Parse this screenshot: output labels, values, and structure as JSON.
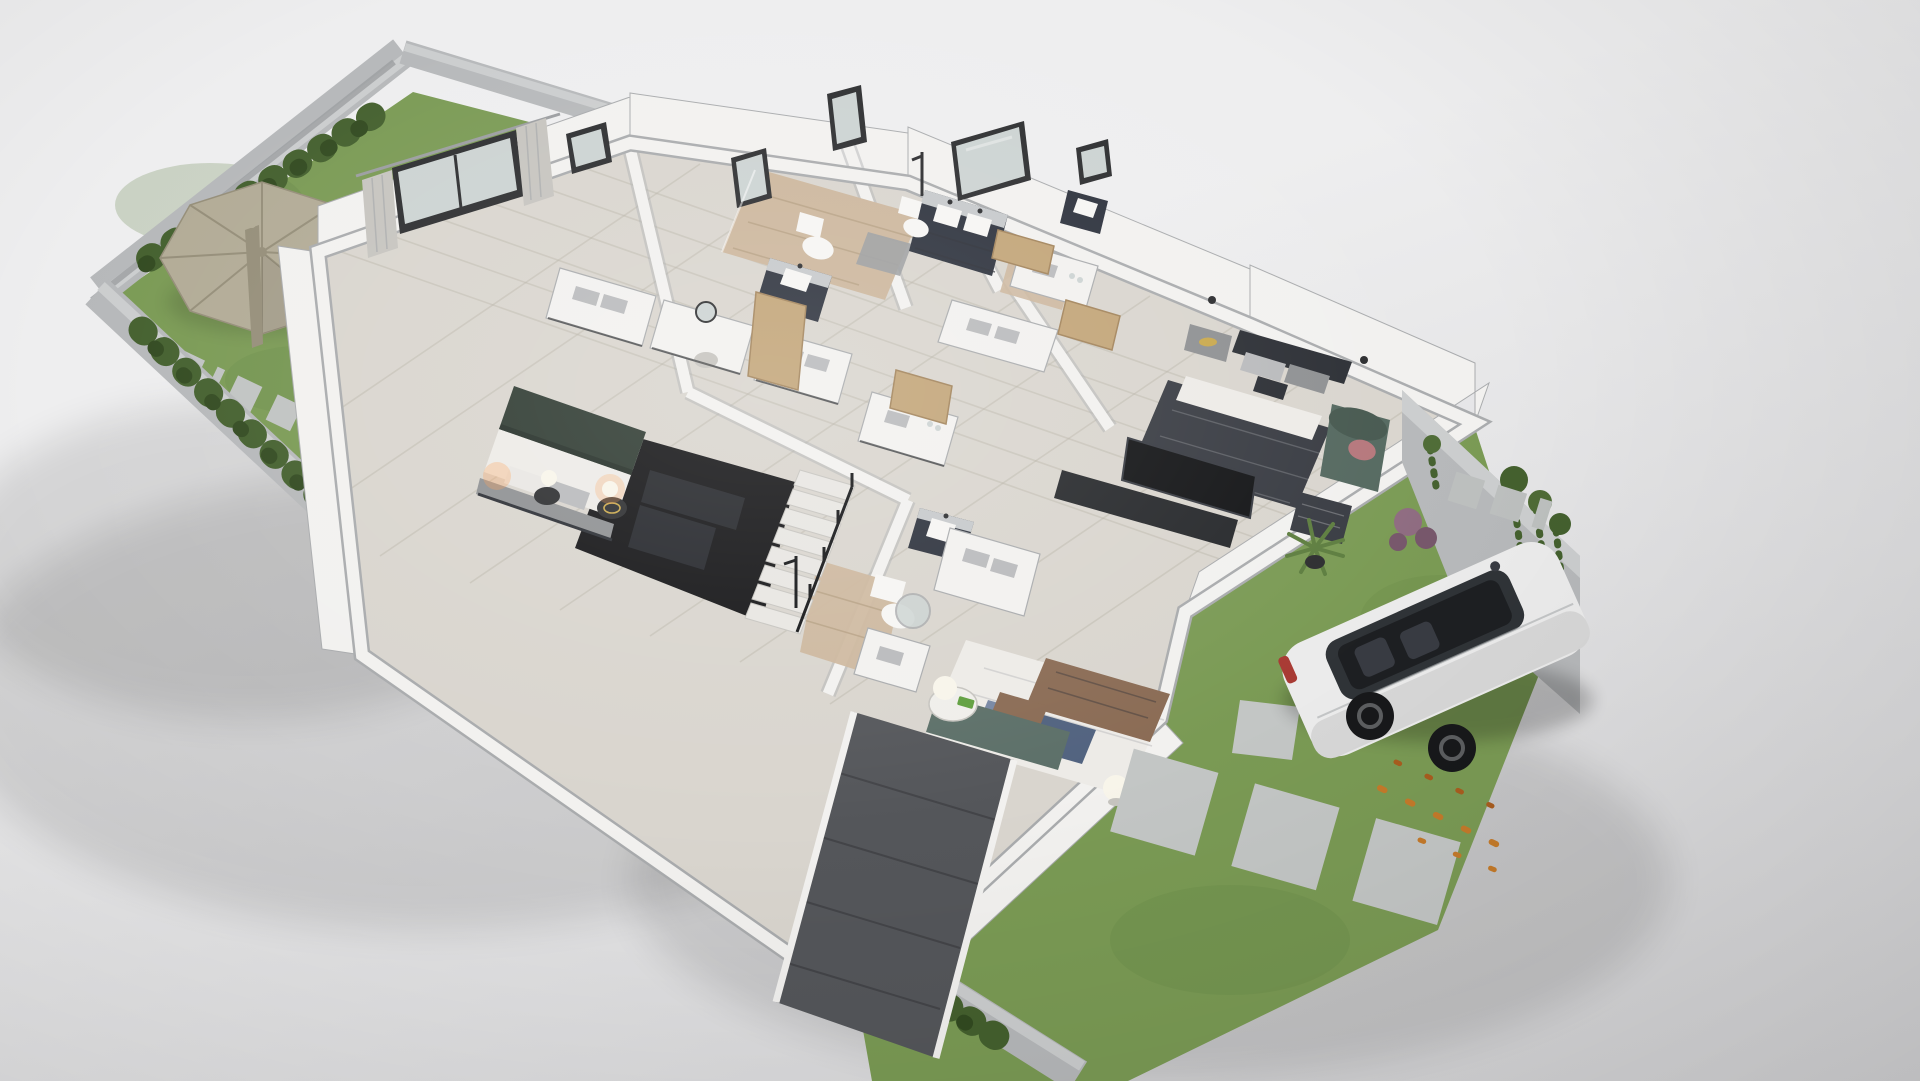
{
  "scene": {
    "kind": "3d-dollhouse-floorplan-render",
    "description": "Photorealistic cutaway 3D floor plan of an upper residential storey on a neutral gray studio backdrop, viewed from a high south-west angle",
    "no_visible_text": true
  },
  "palette": {
    "bg_top": "#eeeeef",
    "bg_bottom": "#d2d2d4",
    "shadow": "#000000",
    "concrete": "#b6b8ba",
    "concrete_light": "#cbcdce",
    "concrete_dark": "#9b9da0",
    "wall_white": "#f2f1ef",
    "wall_edge": "#a9abad",
    "floor_tile": "#d9d5ce",
    "floor_line": "#b4aea3",
    "wood": "#ccb69c",
    "wood_line": "#ac9678",
    "grass": "#7a9a54",
    "grass_dark": "#5f8142",
    "hedge": "#44602e",
    "hedge_dark": "#324a20",
    "stone": "#c0c3c2",
    "paver": "#c3c6c5",
    "paver_small": "#bcbfbe",
    "umbrella": "#b2ab96",
    "umbrella_dark": "#958e79",
    "navy": "#2c313c",
    "navy_top": "#c6c9cb",
    "sink": "#f6f5f3",
    "mattress": "#edebe7",
    "pillow_gray": "#b9babc",
    "duvet_green": "#2e3a31",
    "duvet_green_dark": "#242e27",
    "headboard": "#8e9092",
    "charcoal": "#383b42",
    "charcoal_dark": "#2b2e34",
    "sheet": "#e9e7e3",
    "blue_pillow": "#7787a3",
    "blue_dark": "#51627f",
    "throw_brown": "#8a6b54",
    "teal_sofa": "#5c6f68",
    "teal_chair": "#54685f",
    "teal_chair_dark": "#46584f",
    "pink": "#b5767b",
    "door_tan": "#c2a477",
    "door_tan_dark": "#a2835a",
    "tv": "#131416",
    "console_dark": "#26282b",
    "void": "#141416",
    "void_soft": "#26282c",
    "stairs": "#e8e6e2",
    "riser": "#c6c4bf",
    "ramp": "#54565a",
    "ramp_line": "#3e4043",
    "car_body": "#ebebeb",
    "car_side": "#d7d7d7",
    "car_glass": "#2f3337",
    "car_glass_dark": "#1d1f22",
    "wheel": "#17181a",
    "rim": "#5c5e60",
    "taillight": "#a83a33",
    "leaf_orange": "#c47a2a",
    "leaf_orange2": "#a85d1f",
    "gold": "#c9a84c",
    "lamp": "#f8f5ea",
    "glow_warm": "#ff9d4d",
    "plant": "#4e6b35",
    "plant2": "#5d7d3f",
    "purple_shrub": "#8e6b80",
    "purple_shrub2": "#76566a",
    "mirror_frame": "#2c2d2f",
    "mirror_glass": "#ccd3d2",
    "metal": "#2b2c2e",
    "table_white": "#efeeea",
    "white": "#ffffff",
    "book_green": "#5f9e3e"
  },
  "rooms": [
    {
      "name": "garden-patio",
      "features": [
        "lawn",
        "open-patio-umbrella",
        "closed-umbrella",
        "hedge-rows",
        "stepping-stones",
        "potted-palms",
        "concrete-boundary-walls"
      ]
    },
    {
      "name": "master-bedroom",
      "features": [
        "double-bed-green-duvet",
        "gray-headboard-bench",
        "picture-window-with-curtains",
        "small-window",
        "nightstands-with-globe-lamps",
        "white-dresser-with-towels",
        "vanity-desk-with-round-mirror"
      ]
    },
    {
      "name": "bathroom-top-left",
      "features": [
        "navy-vanity-with-sink",
        "toilet",
        "walk-in-shower-wood-floor",
        "leaning-wall-mirrors"
      ]
    },
    {
      "name": "bathroom-top-right",
      "features": [
        "navy-double-vanity",
        "large-wall-mirror",
        "toilet",
        "wood-floor-shower",
        "extra-navy-vanity"
      ]
    },
    {
      "name": "walk-in-closet",
      "features": [
        "white-console-islands",
        "towel-stacks",
        "open-light-wood-doors"
      ]
    },
    {
      "name": "bedroom-right",
      "features": [
        "double-bed-charcoal-duvet",
        "nightstand-with-gold-tray",
        "wall-sconces",
        "tv-on-dark-media-console",
        "teal-tufted-armchair",
        "patterned-ottoman",
        "potted-plant"
      ]
    },
    {
      "name": "stairwell",
      "features": [
        "white-staircase",
        "open-void-to-lower-floor",
        "black-railing",
        "glimpse-of-lower-lounge"
      ]
    },
    {
      "name": "bathroom-bottom",
      "features": [
        "toilet",
        "navy-vanity-with-sink",
        "white-towel-consoles",
        "round-mirror",
        "black-shower-fixture",
        "wood-floor"
      ]
    },
    {
      "name": "bedroom-bottom",
      "features": [
        "double-bed-white-linen",
        "blue-pillows",
        "brown-throw-blanket",
        "teal-upholstered-frame",
        "round-side-table",
        "two-globe-lamps",
        "green-book"
      ]
    },
    {
      "name": "driveway-lawn",
      "features": [
        "white-suv",
        "panoramic-sunroof",
        "concrete-paver-path",
        "fallen-orange-leaves",
        "purple-shrub",
        "ivy-covered-boundary-wall"
      ]
    },
    {
      "name": "basement-ramp",
      "features": [
        "dark-tiled-ramp",
        "hedge-row",
        "perimeter-wall",
        "grass-strip"
      ]
    }
  ]
}
